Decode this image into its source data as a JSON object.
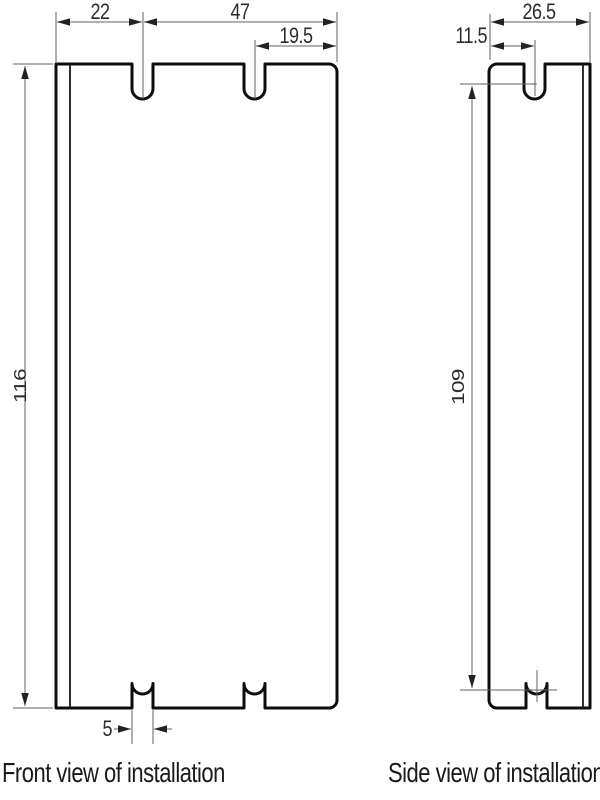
{
  "drawing": {
    "front_view": {
      "label": "Front view of installation",
      "dims": {
        "left_edge_to_slot": "22",
        "slot_to_right_edge": "47",
        "second_slot_to_edge": "19.5",
        "overall_height": "116",
        "slot_width": "5"
      }
    },
    "side_view": {
      "label": "Side view of installation",
      "dims": {
        "overall_width": "26.5",
        "edge_to_slot": "11.5",
        "slot_span_height": "109"
      }
    },
    "colors": {
      "background": "#ffffff",
      "outline": "#0d0d0d",
      "flange_line": "#1a1a1a",
      "dimension_line": "#616161",
      "arrowhead": "#222222",
      "text": "#2b2b2b"
    }
  }
}
